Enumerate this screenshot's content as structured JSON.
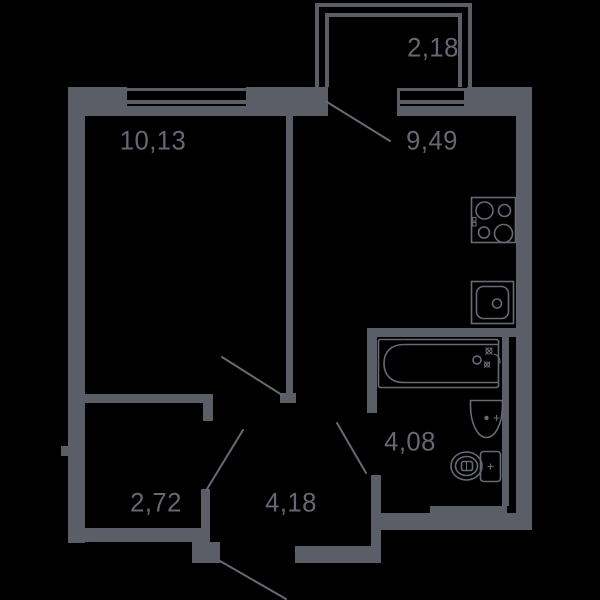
{
  "colors": {
    "background": "#000000",
    "wall": "#5b5e67",
    "line": "#676a75",
    "text": "#656872"
  },
  "rooms": [
    {
      "id": "balcony",
      "area": "2,18"
    },
    {
      "id": "living-room",
      "area": "10,13"
    },
    {
      "id": "kitchen",
      "area": "9,49"
    },
    {
      "id": "bathroom",
      "area": "4,08"
    },
    {
      "id": "storage",
      "area": "2,72"
    },
    {
      "id": "hallway",
      "area": "4,18"
    }
  ],
  "fixtures": [
    {
      "icon": "stove-icon",
      "label": "4-burner stove"
    },
    {
      "icon": "kitchen-sink-icon",
      "label": "kitchen sink"
    },
    {
      "icon": "bathtub-icon",
      "label": "bathtub"
    },
    {
      "icon": "washbasin-icon",
      "label": "washbasin"
    },
    {
      "icon": "toilet-icon",
      "label": "toilet"
    }
  ],
  "doors": [
    {
      "icon": "door-swing-icon",
      "label": "living room door"
    },
    {
      "icon": "door-swing-icon",
      "label": "balcony door"
    },
    {
      "icon": "door-swing-icon",
      "label": "bathroom door"
    },
    {
      "icon": "door-swing-icon",
      "label": "storage door"
    },
    {
      "icon": "door-swing-icon",
      "label": "entry door"
    }
  ]
}
